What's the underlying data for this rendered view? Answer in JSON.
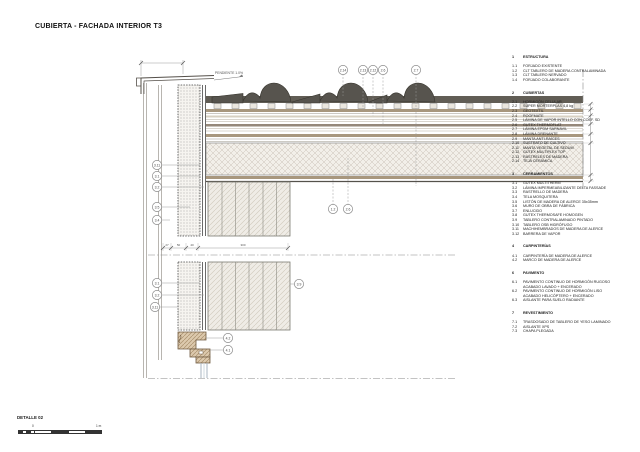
{
  "page": {
    "title": "CUBIERTA - FACHADA INTERIOR T3"
  },
  "detail": {
    "label": "DETALLE 02",
    "scale_zero": "0",
    "scale_end": "1 m"
  },
  "colors": {
    "ink": "#55524c",
    "tile": "#57544e",
    "wood": "#a8977e"
  },
  "drawing": {
    "slope_label": "PENDIENTE 1.0%",
    "dim_values": [
      {
        "x": 167,
        "y": 246,
        "t": "27"
      },
      {
        "x": 178.5,
        "y": 246,
        "t": "50"
      },
      {
        "x": 192,
        "y": 246,
        "t": "40"
      },
      {
        "x": 243,
        "y": 246,
        "t": "300"
      }
    ],
    "callouts": [
      {
        "x": 343,
        "y": 70,
        "label": "2.14",
        "lx": 343,
        "ly": 96,
        "dash": true
      },
      {
        "x": 363,
        "y": 70,
        "label": "2.13",
        "lx": 363,
        "ly": 111,
        "dash": true
      },
      {
        "x": 373,
        "y": 70,
        "label": "2.12",
        "lx": 373,
        "ly": 116,
        "dash": true
      },
      {
        "x": 383,
        "y": 70,
        "label": "2.6",
        "lx": 383,
        "ly": 126,
        "dash": true
      },
      {
        "x": 416,
        "y": 70,
        "label": "2.7",
        "lx": 416,
        "ly": 186,
        "dash": true
      },
      {
        "x": 333,
        "y": 209,
        "label": "1.2",
        "lx": 333,
        "ly": 179,
        "dash": true
      },
      {
        "x": 348,
        "y": 209,
        "label": "2.6",
        "lx": 348,
        "ly": 158,
        "dash": true
      },
      {
        "x": 157,
        "y": 165,
        "label": "3.11",
        "lx": 200,
        "ly": 165
      },
      {
        "x": 157,
        "y": 176,
        "label": "3.1",
        "lx": 200,
        "ly": 176
      },
      {
        "x": 157,
        "y": 187,
        "label": "3.2",
        "lx": 204,
        "ly": 187
      },
      {
        "x": 157,
        "y": 207,
        "label": "3.5",
        "lx": 190,
        "ly": 207
      },
      {
        "x": 157,
        "y": 220,
        "label": "3.4",
        "lx": 170,
        "ly": 220
      },
      {
        "x": 157,
        "y": 283,
        "label": "3.1",
        "lx": 200,
        "ly": 283
      },
      {
        "x": 157,
        "y": 295,
        "label": "3.2",
        "lx": 204,
        "ly": 295
      },
      {
        "x": 155,
        "y": 307,
        "label": "3.11",
        "lx": 178,
        "ly": 307
      },
      {
        "x": 299,
        "y": 284,
        "label": "3.9",
        "lx": 290,
        "ly": 284
      },
      {
        "x": 228,
        "y": 338,
        "label": "4.2",
        "lx": 206,
        "ly": 338
      },
      {
        "x": 228,
        "y": 350,
        "label": "4.1",
        "lx": 210,
        "ly": 350
      }
    ]
  },
  "legend": {
    "sections": [
      {
        "num": "1",
        "title": "ESTRUCTURA",
        "items": [
          {
            "num": "1.1",
            "text": "FORJADO EXISTENTE"
          },
          {
            "num": "1.2",
            "text": "CLT TABLERO DE MADERA CONTRALAMINADA"
          },
          {
            "num": "1.3",
            "text": "CLT TABLERO NERVADO"
          },
          {
            "num": "1.4",
            "text": "FORJADO COLABORANTE"
          }
        ]
      },
      {
        "num": "2",
        "title": "CUBIERTAS",
        "items": [
          {
            "num": "2.1",
            "text": "HORMIGÓN CELULAR"
          },
          {
            "num": "2.2",
            "text": "SUPER MORTERPLAS 4,8 kg"
          },
          {
            "num": "2.3",
            "text": "GEOTEXTIL"
          },
          {
            "num": "2.4",
            "text": "ROOFMATE"
          },
          {
            "num": "2.5",
            "text": "LÁMINA DE VAPOR INTELLO CON COEF. SD"
          },
          {
            "num": "2.6",
            "text": "GUTEX THERMOFLAT"
          },
          {
            "num": "2.7",
            "text": "LÁMINA EPDM SARNAVIL"
          },
          {
            "num": "2.8",
            "text": "LÁMINA DRENANTE"
          },
          {
            "num": "2.9",
            "text": "MANTA ANTI-RAÍCES"
          },
          {
            "num": "2.10",
            "text": "SUSTRATO DE CULTIVO"
          },
          {
            "num": "2.11",
            "text": "MANTA VEGETAL DE SEDUM"
          },
          {
            "num": "2.12",
            "text": "GUTEX MULTIPLEX TOP"
          },
          {
            "num": "2.13",
            "text": "RASTRELES DE MADERA"
          },
          {
            "num": "2.14",
            "text": "TEJA CERÁMICA"
          }
        ]
      },
      {
        "num": "3",
        "title": "CERRAMIENTOS",
        "items": [
          {
            "num": "3.1",
            "text": "GUTEX MULTITHERM"
          },
          {
            "num": "3.2",
            "text": "LÁMINA IMPERMEABILIZANTE DELTA FASSADE"
          },
          {
            "num": "3.3",
            "text": "RASTRELLO DE MADERA"
          },
          {
            "num": "3.4",
            "text": "TELA MOSQUITERA"
          },
          {
            "num": "3.5",
            "text": "LISTÓN DE MADERA DE ALERCE 35x35mm"
          },
          {
            "num": "3.6",
            "text": "MURO DE OBRA DE FÁBRICA"
          },
          {
            "num": "3.7",
            "text": "ENLUCIDO"
          },
          {
            "num": "3.8",
            "text": "GUTEX THERMOSAFE HOMOGEN"
          },
          {
            "num": "3.9",
            "text": "TABLERO CONTRALAMINADO PINTADO"
          },
          {
            "num": "3.10",
            "text": "TABLERO OSB HIDRÓFUGO"
          },
          {
            "num": "3.11",
            "text": "MACHIHEMBRADOS DE MADERA DE ALERCE"
          },
          {
            "num": "3.12",
            "text": "BARRERA DE VAPOR"
          }
        ]
      },
      {
        "num": "4",
        "title": "CARPINTERÍAS",
        "items": [
          {
            "num": "4.1",
            "text": "CARPINTERÍA DE MADERA DE ALERCE"
          },
          {
            "num": "4.2",
            "text": "MARCO DE MADERA DE ALERCE"
          }
        ]
      },
      {
        "num": "6",
        "title": "PAVIMENTO",
        "items": [
          {
            "num": "6.1",
            "text": "PAVIMENTO CONTINUO DE HORMIGÓN RUGOSO\nACABADO LAVADO + ENCERADO"
          },
          {
            "num": "6.2",
            "text": "PAVIMENTO CONTINUO DE HORMIGÓN LISO\nACABADO HELICÓPTERO + ENCERADO"
          },
          {
            "num": "6.3",
            "text": "AISLANTE PARA SUELO RADIANTE"
          }
        ]
      },
      {
        "num": "7",
        "title": "REVESTIMIENTO",
        "items": [
          {
            "num": "7.1",
            "text": "TRASDOSADO DE TABLERO DE YESO LAMINADO"
          },
          {
            "num": "7.2",
            "text": "AISLANTE XPS"
          },
          {
            "num": "7.3",
            "text": "CHAPA PLEGADA"
          }
        ]
      }
    ]
  }
}
